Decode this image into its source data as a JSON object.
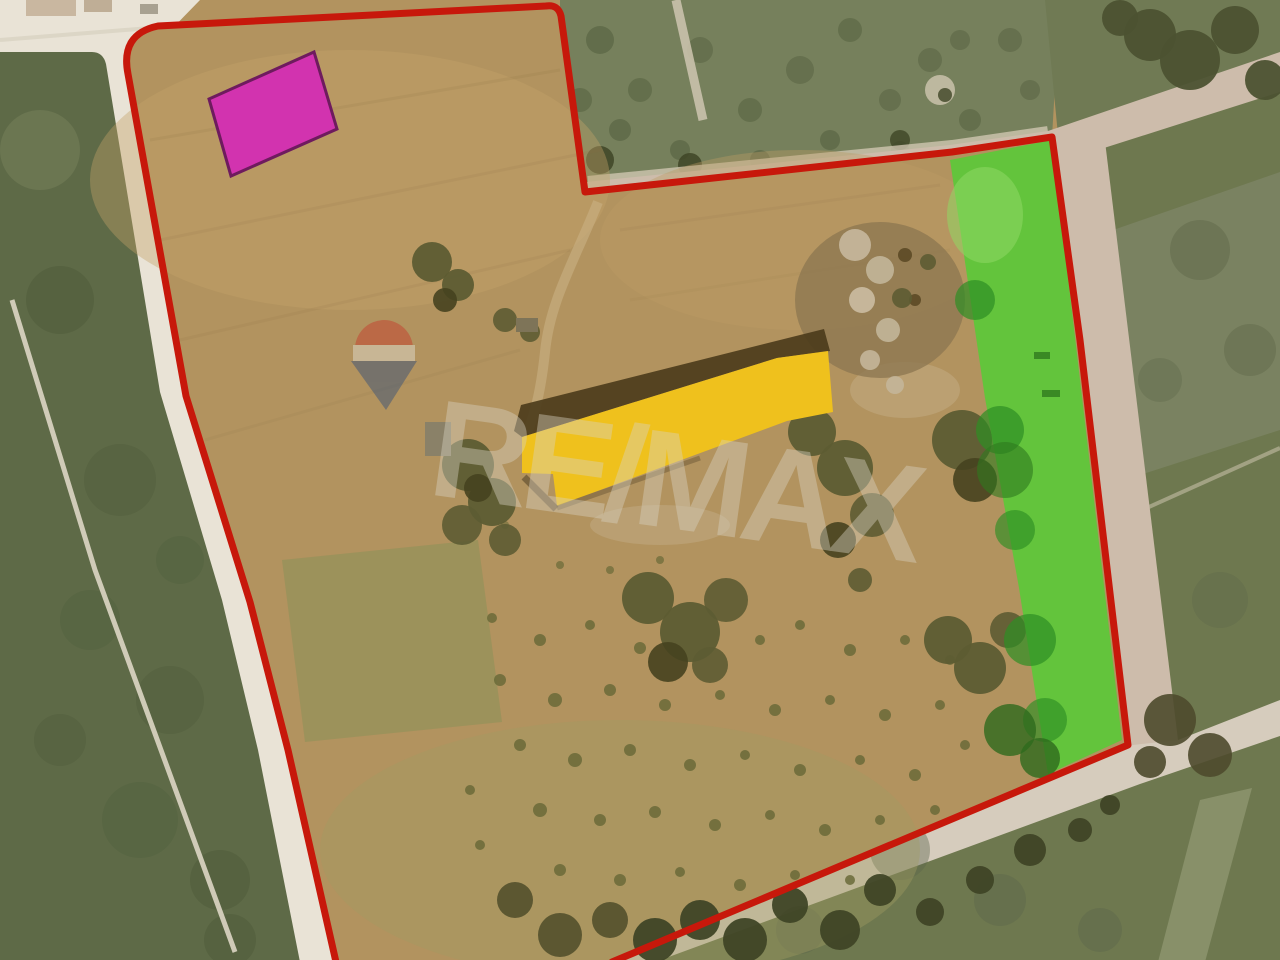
{
  "image": {
    "type": "aerial-parcel-photo",
    "width": 1280,
    "height": 960
  },
  "watermark": {
    "text": "RE/MAX",
    "text_color": "#d8d2c2",
    "balloon_top_color": "#c5402f",
    "balloon_band_color": "#ded9cc",
    "balloon_bottom_color": "#3c5378"
  },
  "overlays": {
    "boundary": {
      "label": "parcel-boundary",
      "color": "#c7180b"
    },
    "building_highlight": {
      "label": "building-highlight",
      "color": "#efc11d"
    },
    "green_zone": {
      "label": "green-zone-strip",
      "color": "#63c43c"
    },
    "magenta_zone": {
      "label": "magenta-marker",
      "color": "#d233af",
      "border": "#6e1b5e"
    }
  },
  "terrain": {
    "parcel": "#b2935f",
    "road_white": "#e9e3d6",
    "field_dark_green": "#5e6a47",
    "scrub_green": "#76805c",
    "right_field": "#6e784f",
    "road_pink": "#cdbcab",
    "road_bottom": "#d6ccbd",
    "roof_shadow": "#4a3b1b",
    "ruin_soil": "#8b7550"
  }
}
